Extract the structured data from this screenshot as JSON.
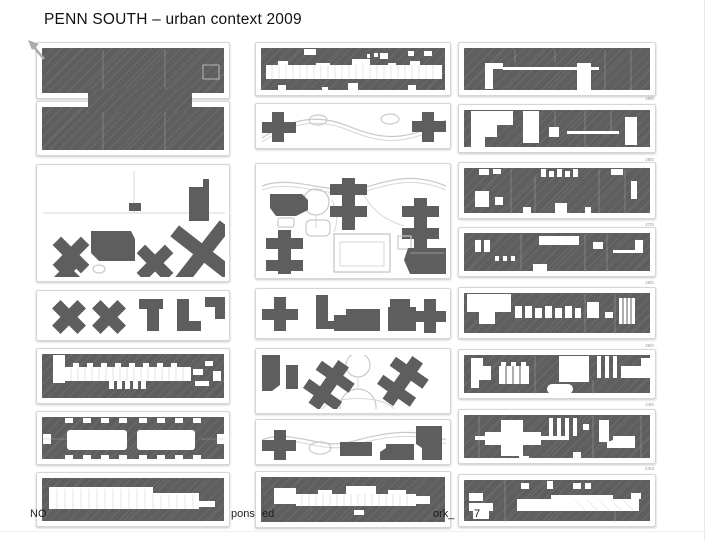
{
  "title": "PENN SOUTH – urban context 2009",
  "colors": {
    "building": "#5e5e5e",
    "panel_border": "#d6d6d6",
    "path_line": "#c9c9c9",
    "street_label": "#9a9a9a",
    "background": "#ffffff"
  },
  "grid": {
    "columns": 3,
    "left_panel_count": 7,
    "middle_panel_count": 7,
    "right_panel_count": 8
  },
  "street_labels": [
    "29th",
    "28th",
    "27th",
    "26th",
    "25th",
    "24th",
    "23rd"
  ],
  "footer_fragments": [
    {
      "text": "NO"
    },
    {
      "text": "pons"
    },
    {
      "text": "ed"
    },
    {
      "text": "ork_"
    },
    {
      "text": "7"
    }
  ]
}
